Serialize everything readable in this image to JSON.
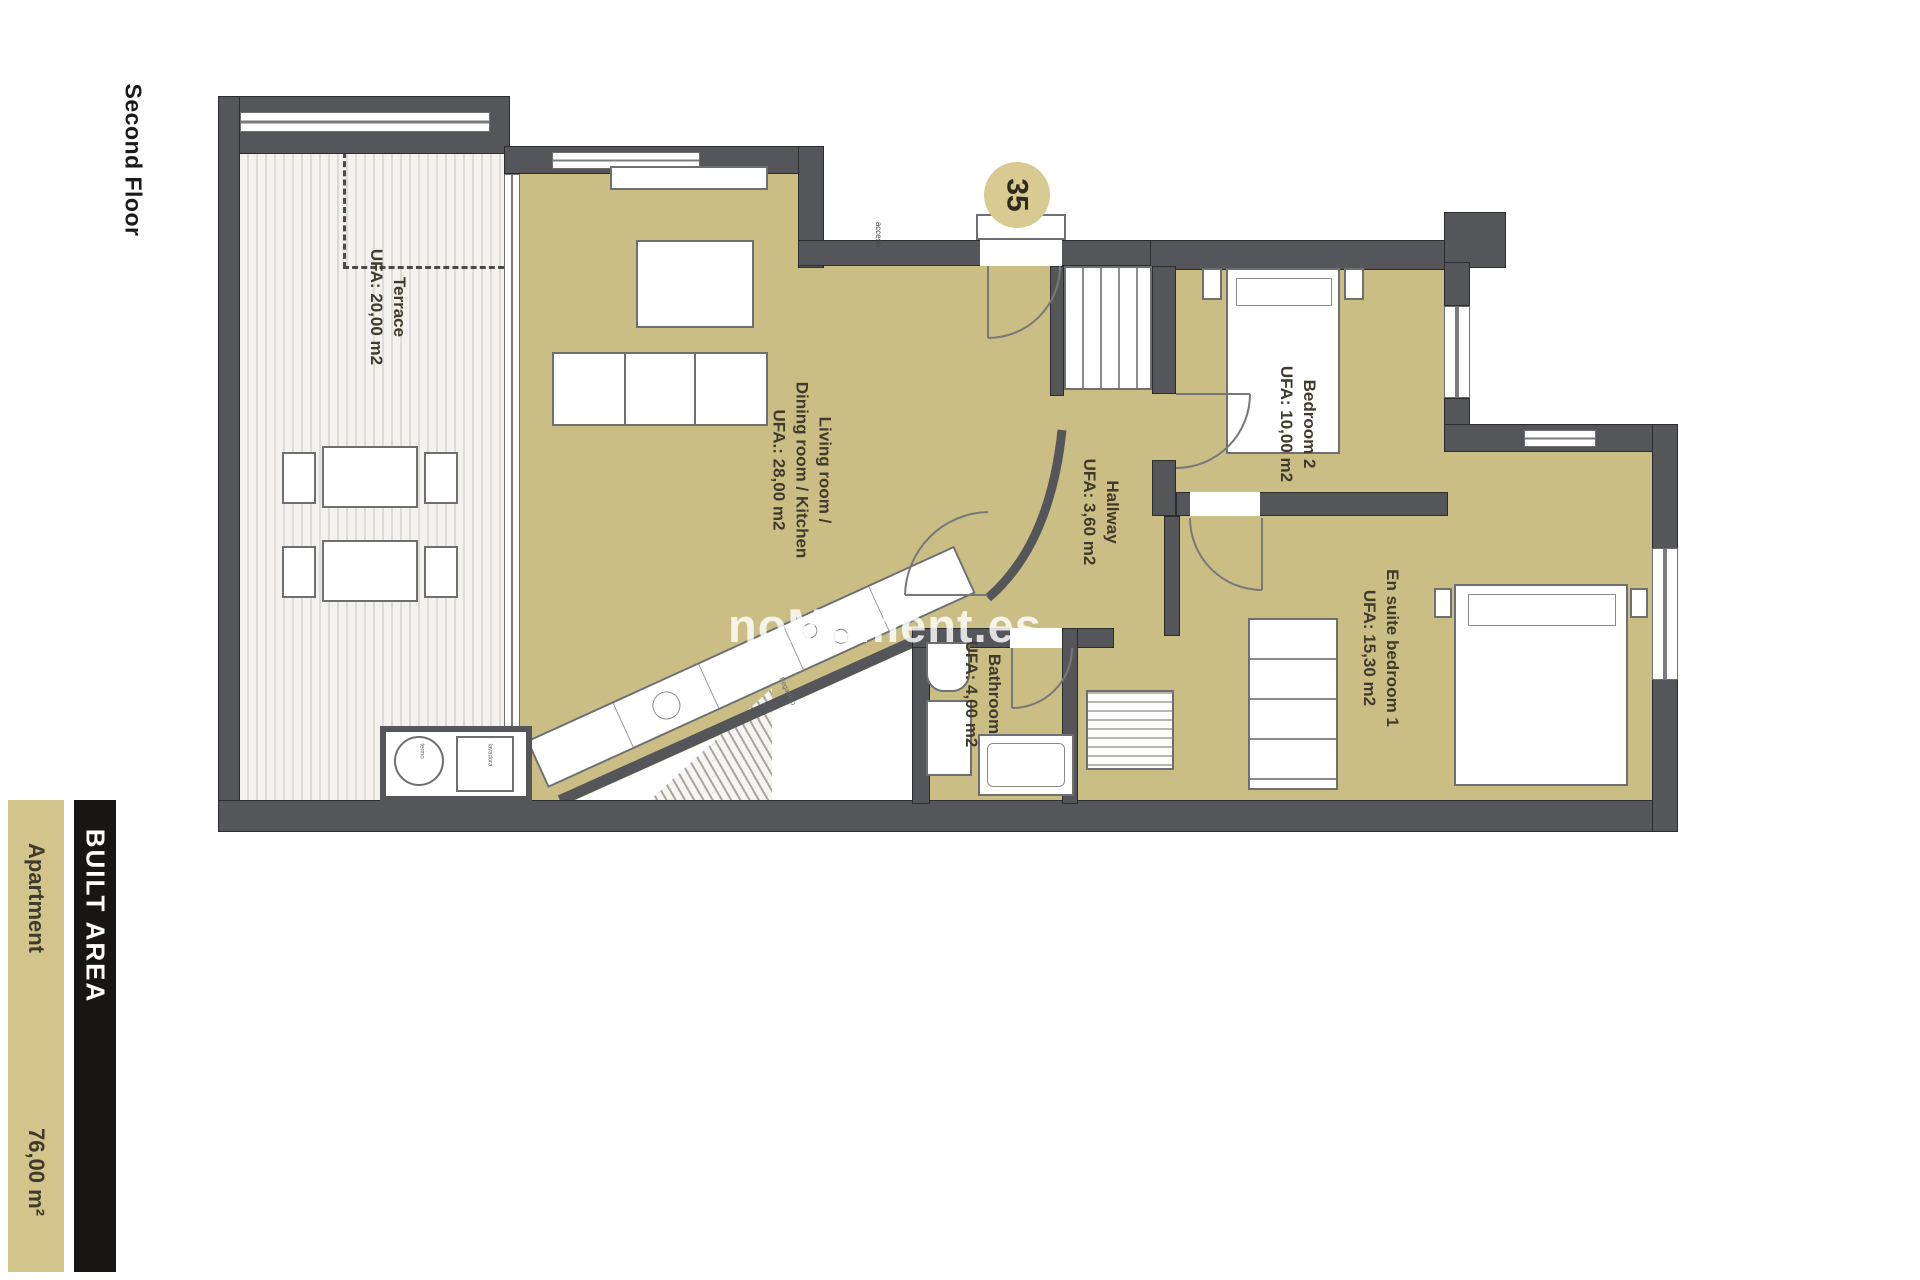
{
  "floor": {
    "label": "Second Floor"
  },
  "unit": {
    "number": "35"
  },
  "watermark": {
    "text": "noMoment.es"
  },
  "rooms": {
    "terrace": {
      "name": "Terrace",
      "area": "UFA: 20,00 m2"
    },
    "living": {
      "name1": "Living room /",
      "name2": "Dining room / Kitchen",
      "area": "UFA.: 28,00 m2"
    },
    "hallway": {
      "name": "Hallway",
      "area": "UFA: 3,60 m2"
    },
    "bedroom2": {
      "name": "Bedroom 2",
      "area": "UFA: 10,00 m2"
    },
    "ensuite": {
      "name": "En suite bedroom 1",
      "area": "UFA: 15,30 m2"
    },
    "bathroom": {
      "name": "Bathroom",
      "area": "UFA: 4,00 m2"
    }
  },
  "tiny_labels": {
    "entry": "acceso",
    "boiler": "termo",
    "washer": "lavadora",
    "counter": "fregadero"
  },
  "built_area": {
    "header": "BUILT AREA",
    "rows": [
      {
        "label": "Apartment",
        "value": "76,00 m²"
      }
    ]
  },
  "colors": {
    "room_fill": "#cbbe85",
    "wall": "#55565a",
    "table_accent": "#d2c48b",
    "table_header_bg": "#171615",
    "label_text": "#3f3a2c"
  }
}
